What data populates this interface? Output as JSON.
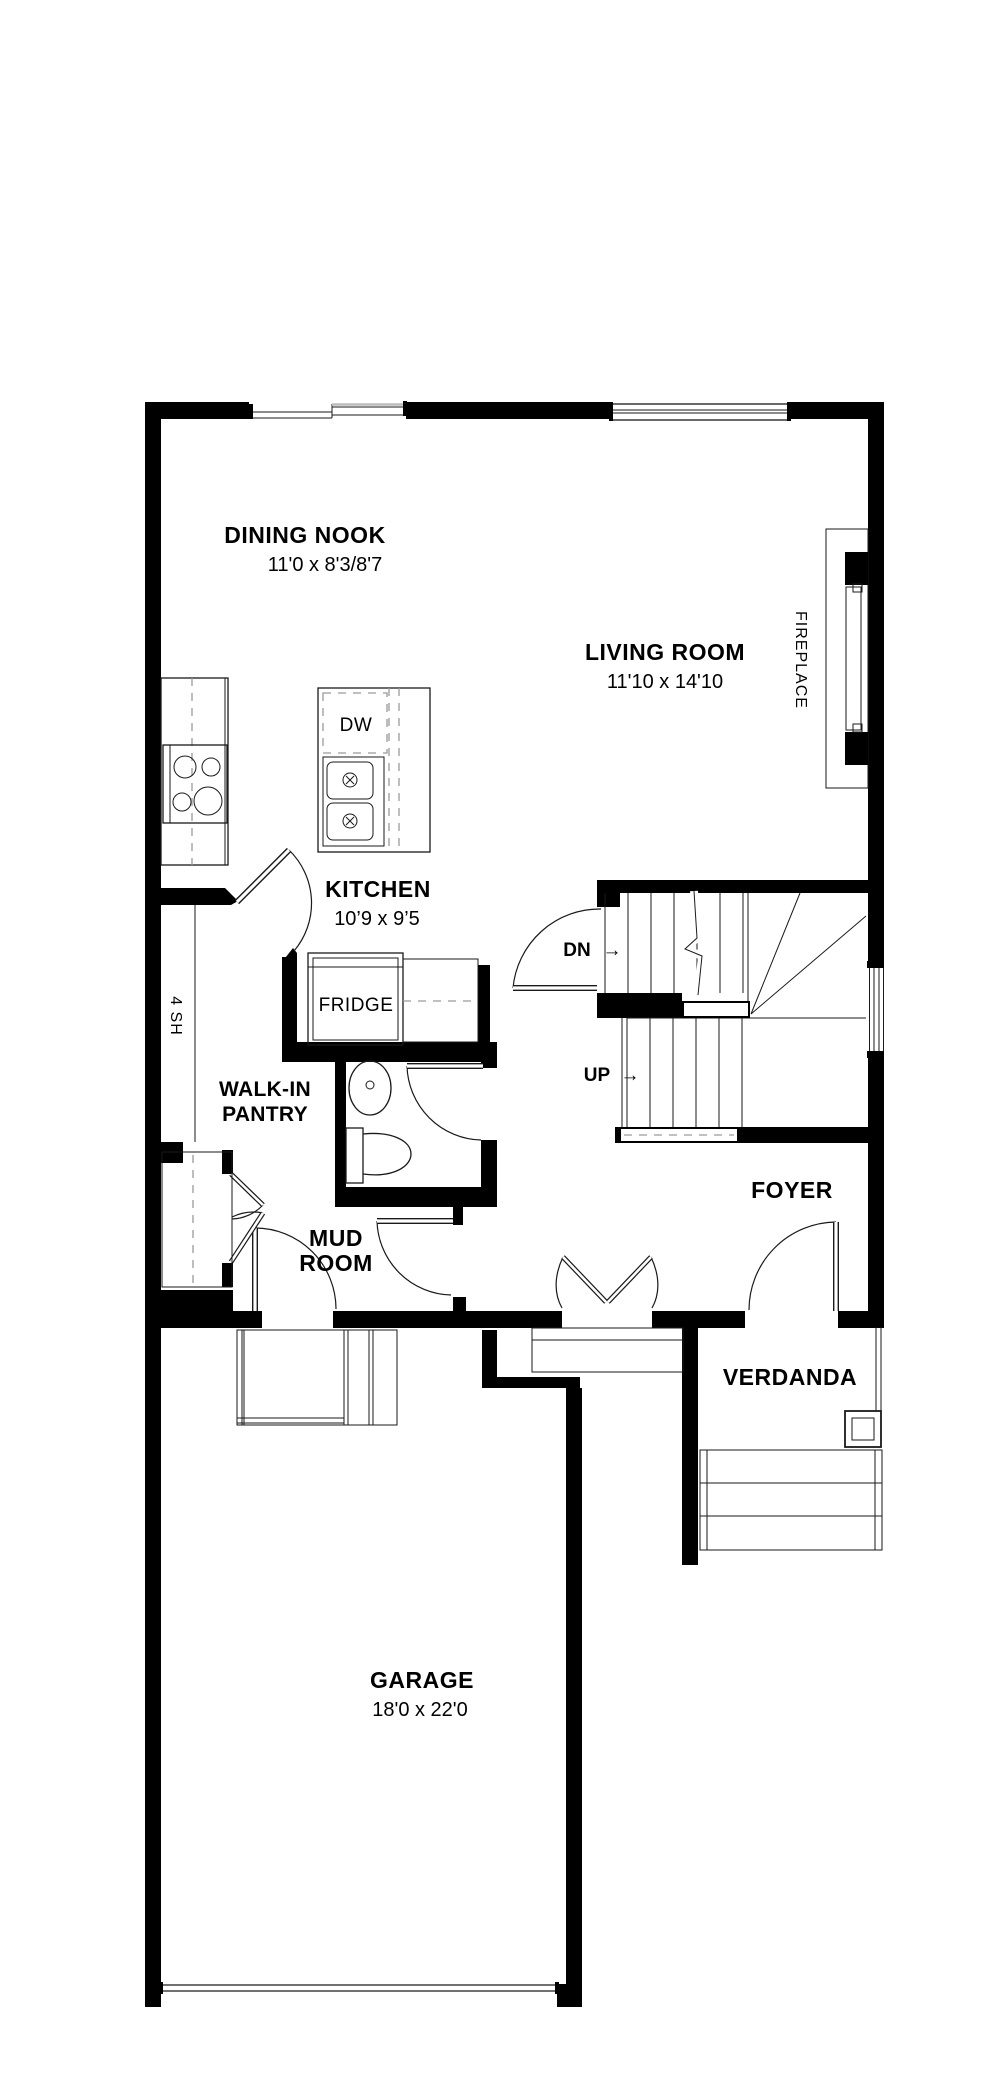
{
  "colors": {
    "background": "#ffffff",
    "walls": "#000000",
    "thin_lines": "#1a1a1a",
    "dashed_lines": "#9a9a9a"
  },
  "rooms": {
    "dining_nook": {
      "name": "DINING NOOK",
      "dims": "11'0 x 8'3/8'7"
    },
    "living_room": {
      "name": "LIVING ROOM",
      "dims": "11'10 x 14'10"
    },
    "kitchen": {
      "name": "KITCHEN",
      "dims": "10’9 x 9’5"
    },
    "walk_in_pantry": {
      "line1": "WALK-IN",
      "line2": "PANTRY"
    },
    "mud_room": {
      "line1": "MUD",
      "line2": "ROOM"
    },
    "foyer": {
      "name": "FOYER"
    },
    "verdanda": {
      "name": "VERDANDA"
    },
    "garage": {
      "name": "GARAGE",
      "dims": "18'0 x 22'0"
    }
  },
  "features": {
    "fireplace": "FIREPLACE",
    "fridge": "FRIDGE",
    "dishwasher": "DW",
    "pantry_shelves": "4 SH",
    "stairs": {
      "down": "DN",
      "up": "UP",
      "arrow": "→"
    }
  }
}
